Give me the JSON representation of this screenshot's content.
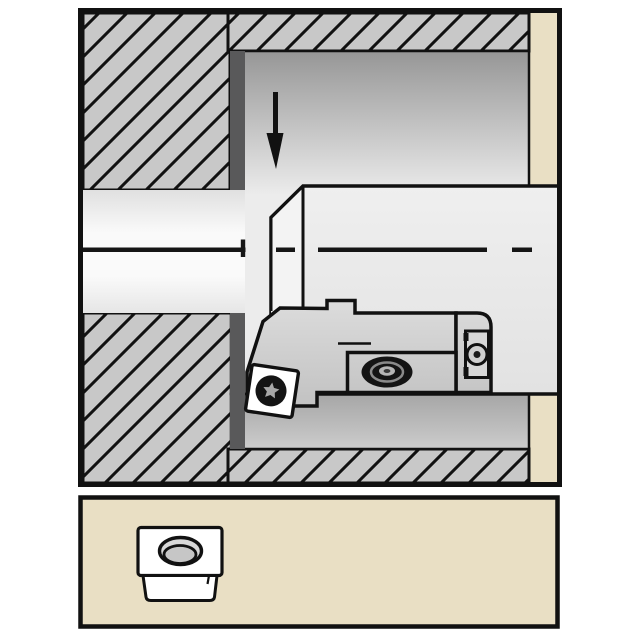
{
  "illustration": {
    "kind": "technical-line-drawing",
    "scene": "Cross-section of a workpiece bore with a cylindrical boring bar and screw-clamp indexable insert; detail panel below shows the insert with center hole",
    "feed_arrow_direction": "down",
    "centerline_style": "dash-dot",
    "hatch_angle_deg": 45,
    "text_content": ""
  },
  "colors": {
    "page_bg": "#ffffff",
    "outline": "#111111",
    "frame_bg": "#e9dfc4",
    "hatch_fill": "#c8c8c8",
    "bore_shadow": "#59595a",
    "bar_fill": "#e9e9e9",
    "chamfer_fill": "#f3f3f3",
    "head_fill": "#cfcfcf",
    "insert_face": "#ffffff",
    "screw_dark": "#141414",
    "torx_star": "#a8a8a8",
    "oval_ring": "#8a8a8a",
    "oval_center": "#b5b5b5",
    "icon_hole_fill": "#d8d8d8",
    "icon_hole_inner": "#c6c6c6",
    "arrow_fill": "#111111"
  },
  "panels": {
    "main": {
      "name": "bore-machining-section",
      "workpiece": "hatched upper and lower walls with stepped bore",
      "tool": "boring bar with cartridge, clamp screw and insert"
    },
    "detail": {
      "name": "insert-detail-box",
      "content": "square screw-clamp insert with countersunk center hole"
    }
  }
}
